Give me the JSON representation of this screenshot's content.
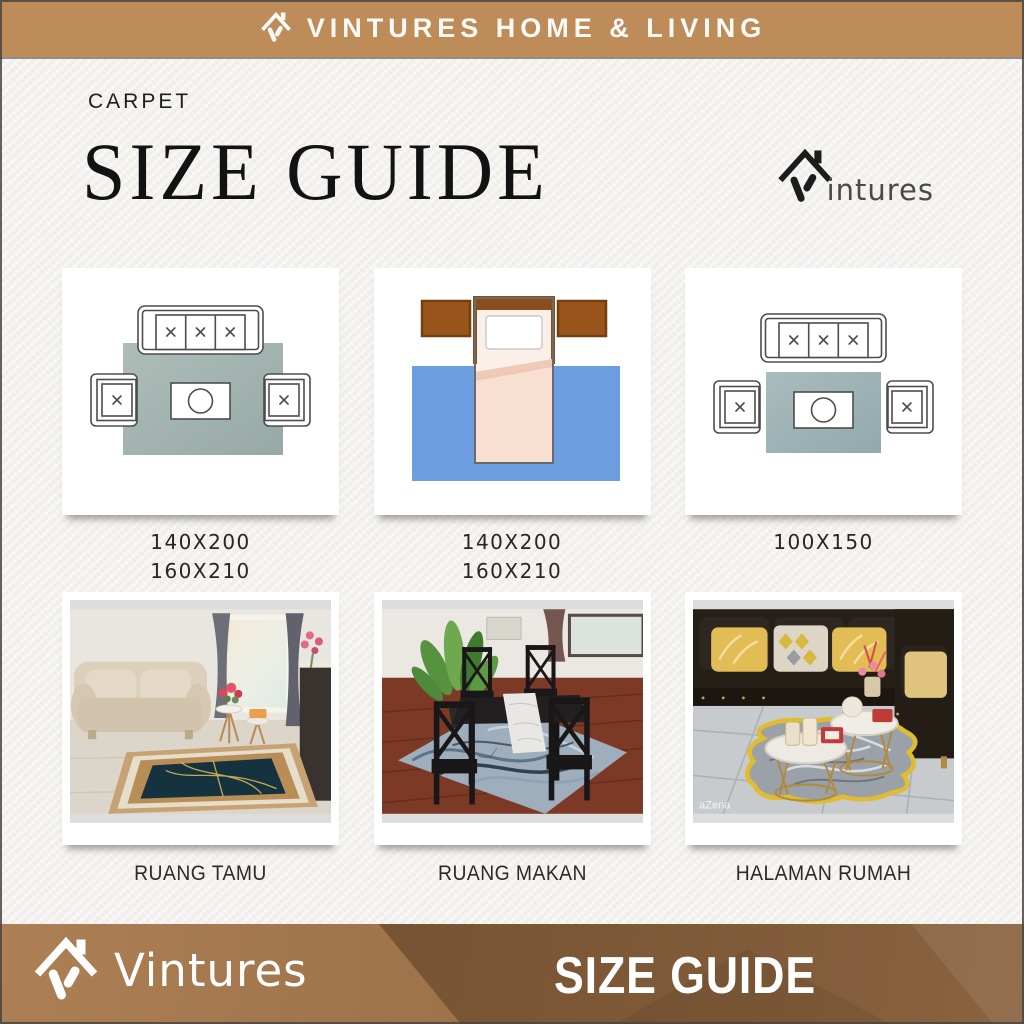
{
  "top_banner": {
    "brand_name": "VINTURES HOME & LIVING"
  },
  "header": {
    "category_label": "CARPET",
    "title": "SIZE GUIDE",
    "logo_suffix": "intures"
  },
  "diagram_cards": [
    {
      "id": "living-room-large-rug",
      "description": "Top view: three-seat sofa, two armchairs and coffee table placed on a large grey-green rug",
      "size_lines": [
        "140X200",
        "160X210"
      ]
    },
    {
      "id": "bedroom-rug",
      "description": "Top view: bed with two brown bedside tables over a blue rug",
      "size_lines": [
        "140X200",
        "160X210"
      ]
    },
    {
      "id": "living-room-small-rug",
      "description": "Top view: sofa and armchairs around a smaller centered rug holding only the coffee table",
      "size_lines": [
        "100X150"
      ]
    }
  ],
  "photo_cards": [
    {
      "caption": "RUANG TAMU"
    },
    {
      "caption": "RUANG MAKAN"
    },
    {
      "caption": "HALAMAN RUMAH",
      "watermark": "aZena"
    }
  ],
  "bottom_banner": {
    "brand_name": "Vintures",
    "label": "SIZE GUIDE"
  },
  "colors": {
    "banner_tan": "#BE8C59",
    "banner_dark_brown": "#6E4D2F",
    "paper": "#F3F1EE",
    "diagram_line": "#4D4D4D",
    "rug_gray_green": "#A8B8B3",
    "rug_blue": "#6D9EE1",
    "nightstand_brown": "#9A551C",
    "blanket_pink": "#F7DFD2",
    "rug_navy_gold": "#14333F",
    "rug_gold_border": "#C7A273",
    "rug_marble_blue": "#9FAEBC",
    "rug_yellow_edge": "#E0BC2E"
  }
}
